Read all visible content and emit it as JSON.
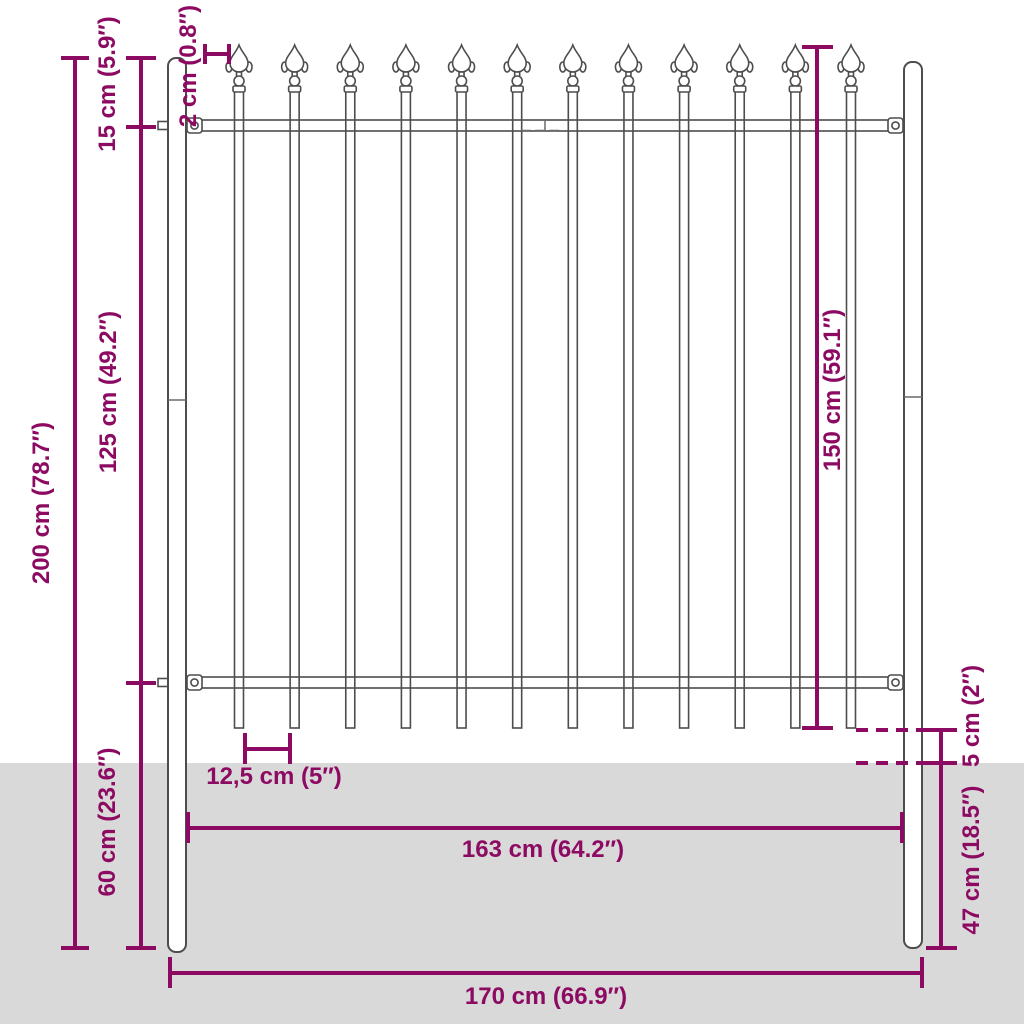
{
  "colors": {
    "accent": "#8d0a62",
    "steel_outline": "#4d4d4d",
    "ground": "#d9d9d9",
    "background": "#ffffff"
  },
  "fence": {
    "picket_count": 12,
    "post_count": 2,
    "rail_count": 2
  },
  "dimensions": {
    "total_height": "200 cm (78.7″)",
    "spear_to_rail": "15 cm (5.9″)",
    "rail_to_rail": "125 cm (49.2″)",
    "post_below_rail": "60 cm (23.6″)",
    "picket_thickness": "2 cm (0.8″)",
    "panel_height": "150 cm (59.1″)",
    "ground_gap": "5 cm (2″)",
    "post_in_ground": "47 cm (18.5″)",
    "picket_spacing": "12,5 cm (5″)",
    "panel_width": "163 cm (64.2″)",
    "total_width": "170 cm (66.9″)"
  }
}
